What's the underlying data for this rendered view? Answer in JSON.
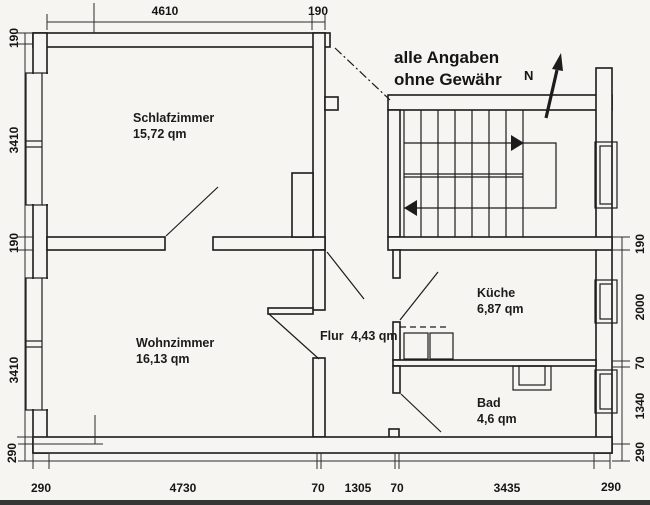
{
  "disclaimer": {
    "line1": "alle Angaben",
    "line2": "ohne Gewähr"
  },
  "north_label": "N",
  "rooms": [
    {
      "name": "Schlafzimmer",
      "area": "15,72 qm"
    },
    {
      "name": "Wohnzimmer",
      "area": "16,13 qm"
    },
    {
      "name": "Flur",
      "area": "4,43 qm"
    },
    {
      "name": "Küche",
      "area": "6,87 qm"
    },
    {
      "name": "Bad",
      "area": "4,6 qm"
    }
  ],
  "dimensions": {
    "top": [
      "4610",
      "190"
    ],
    "left": [
      "190",
      "3410",
      "190",
      "3410",
      "290"
    ],
    "right": [
      "190",
      "2000",
      "70",
      "1340",
      "290"
    ],
    "bottom": [
      "290",
      "4730",
      "70",
      "1305",
      "70",
      "3435",
      "290"
    ]
  },
  "colors": {
    "line": "#1c1c1c",
    "background": "#f6f5f1"
  }
}
